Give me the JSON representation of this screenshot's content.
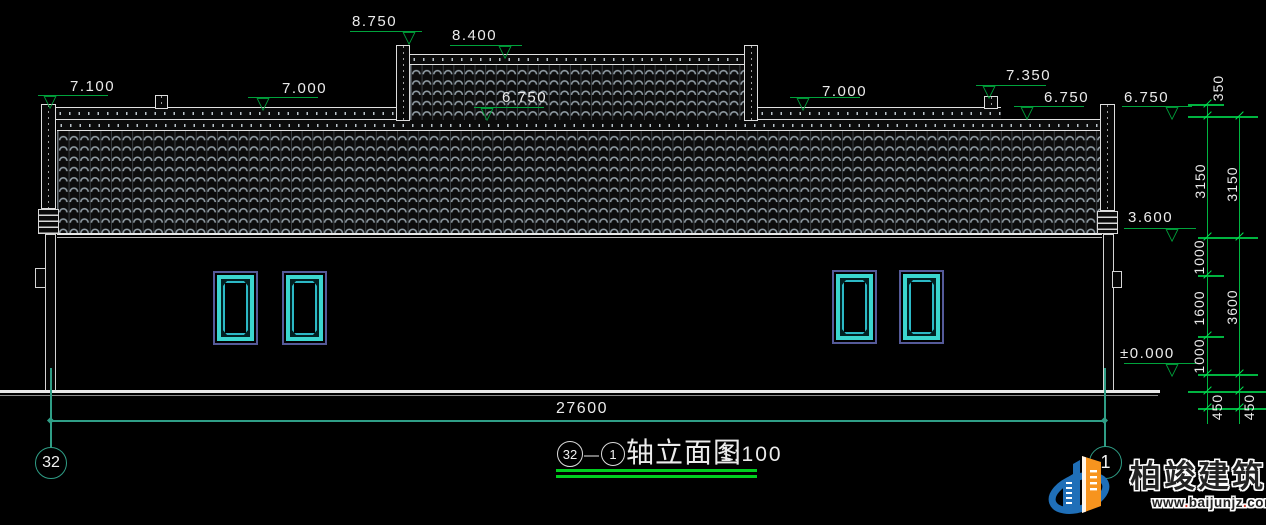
{
  "annotations": {
    "levels": [
      {
        "label": "8.750"
      },
      {
        "label": "8.400"
      },
      {
        "label": "7.100"
      },
      {
        "label": "7.000"
      },
      {
        "label": "6.750"
      },
      {
        "label": "7.000"
      },
      {
        "label": "7.350"
      },
      {
        "label": "6.750"
      },
      {
        "label": "6.750"
      },
      {
        "label": "3.600"
      },
      {
        "label": "±0.000"
      }
    ],
    "vertical_dims_inner": [
      "350",
      "3150",
      "1000",
      "1600",
      "1000",
      "450"
    ],
    "vertical_dims_outer": [
      "3150",
      "3600",
      "450"
    ],
    "overall_width": "27600"
  },
  "axis_bubbles": {
    "left": "32",
    "right": "1"
  },
  "title_block": {
    "left_axis": "32",
    "dash": "—",
    "right_axis": "1",
    "name": "轴立面图",
    "scale": "1:100"
  },
  "watermark": {
    "brand": "柏竣建筑",
    "url_parts": [
      "www",
      ".",
      "baijunjz",
      ".",
      "com"
    ]
  },
  "colors": {
    "annotation_green": "#00a33c",
    "dimension_green": "#00b440",
    "axis_teal": "#2f9e86",
    "underline_green": "#00cf1f",
    "window_cyan": "#3bd6cf",
    "window_border_blue": "#555a99",
    "logo_blue": "#1f6fb8",
    "logo_orange": "#f7941e"
  }
}
